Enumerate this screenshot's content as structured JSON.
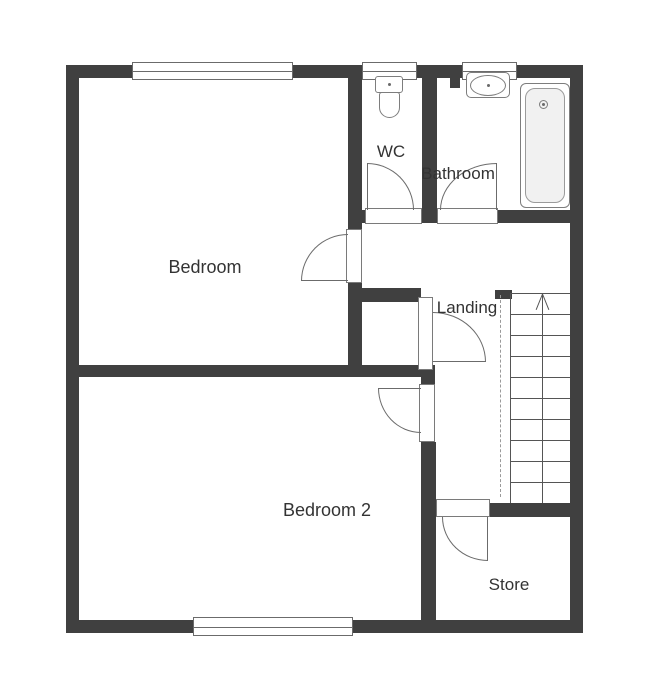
{
  "plan": {
    "type": "floorplan-diagram",
    "rooms": {
      "bedroom": {
        "label": "Bedroom"
      },
      "wc": {
        "label": "WC"
      },
      "bathroom": {
        "label": "Bathroom"
      },
      "landing": {
        "label": "Landing"
      },
      "bedroom2": {
        "label": "Bedroom 2"
      },
      "store": {
        "label": "Store"
      }
    },
    "fixtures": {
      "toilet": "toilet-icon",
      "sink": "sink-icon",
      "bathtub": "bathtub-icon",
      "stairs": "stairs-up-arrow-icon"
    },
    "stairs": {
      "tread_count": 10,
      "direction": "up"
    },
    "windows": {
      "count": 4
    },
    "doors": {
      "count": 6
    },
    "colors": {
      "wall": "#404040",
      "line": "#6b6b6b",
      "thin": "#555555",
      "text": "#333333",
      "bg": "#ffffff",
      "tubfill": "#f1f1f1",
      "dash": "#9a9a9a"
    }
  }
}
